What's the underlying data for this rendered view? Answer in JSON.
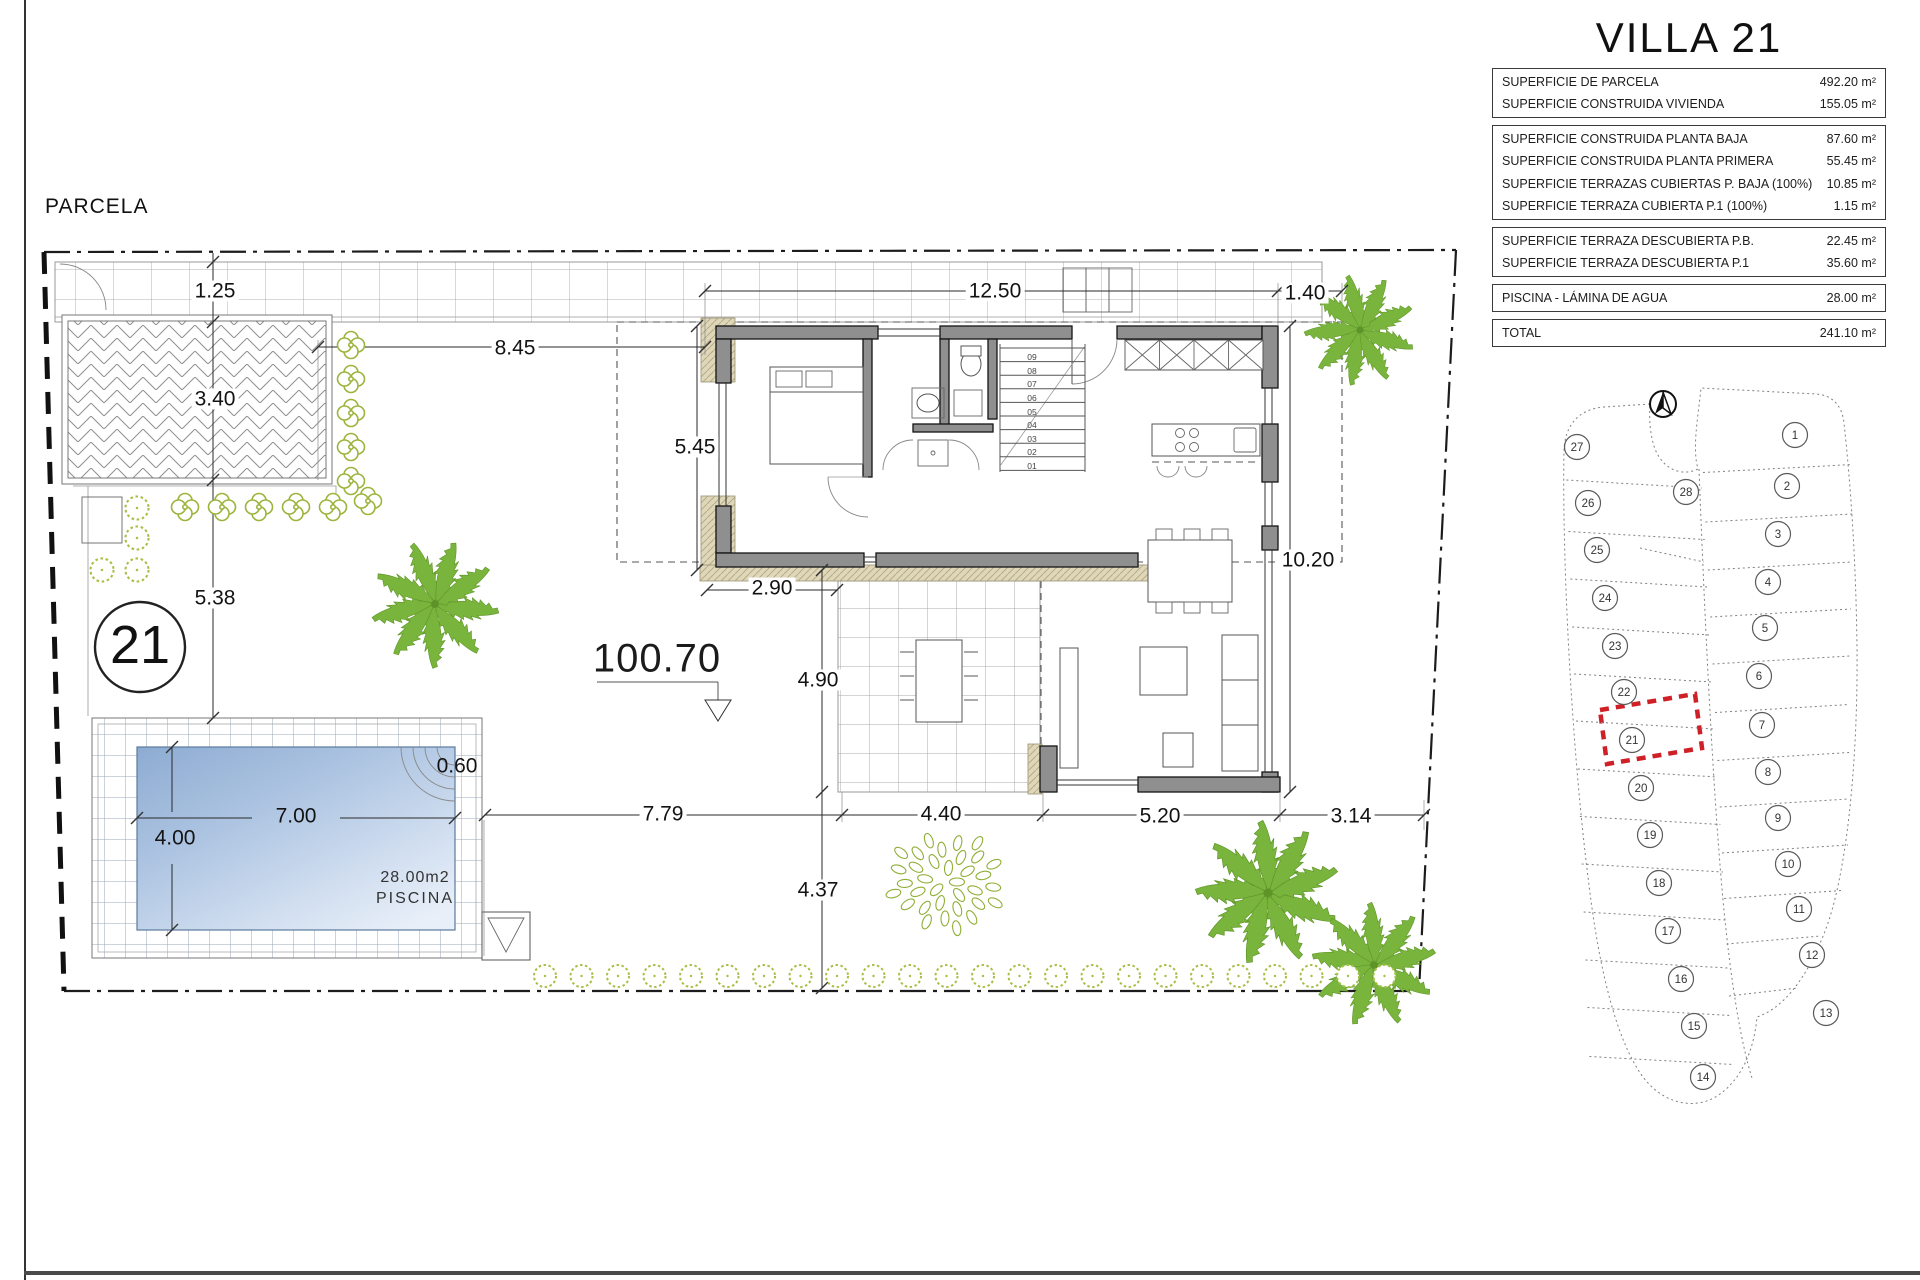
{
  "page": {
    "plan_label": "PARCELA"
  },
  "villa": {
    "title": "VILLA 21"
  },
  "area_table": {
    "groups": [
      {
        "rows": [
          {
            "label": "SUPERFICIE DE PARCELA",
            "value": "492.20 m²"
          },
          {
            "label": "SUPERFICIE CONSTRUIDA VIVIENDA",
            "value": "155.05 m²"
          }
        ]
      },
      {
        "rows": [
          {
            "label": "SUPERFICIE CONSTRUIDA PLANTA BAJA",
            "value": "87.60 m²"
          },
          {
            "label": "SUPERFICIE CONSTRUIDA PLANTA PRIMERA",
            "value": "55.45 m²"
          },
          {
            "label": "SUPERFICIE TERRAZAS CUBIERTAS P. BAJA (100%)",
            "value": "10.85 m²"
          },
          {
            "label": "SUPERFICIE TERRAZA CUBIERTA P.1 (100%)",
            "value": "1.15 m²"
          }
        ]
      },
      {
        "rows": [
          {
            "label": "SUPERFICIE TERRAZA DESCUBIERTA P.B.",
            "value": "22.45 m²"
          },
          {
            "label": "SUPERFICIE TERRAZA DESCUBIERTA P.1",
            "value": "35.60 m²"
          }
        ]
      },
      {
        "rows": [
          {
            "label": "PISCINA - LÁMINA DE AGUA",
            "value": "28.00 m²"
          }
        ]
      },
      {
        "rows": [
          {
            "label": "TOTAL",
            "value": "241.10 m²"
          }
        ]
      }
    ]
  },
  "plan": {
    "plot_number": "21",
    "level_mark": "100.70",
    "pool": {
      "area_label": "28.00m2",
      "name_label": "PISCINA"
    },
    "stair_steps": [
      "01",
      "02",
      "03",
      "04",
      "05",
      "06",
      "07",
      "08",
      "09"
    ],
    "dimensions": [
      {
        "text": "1.25",
        "x": 215,
        "y": 291
      },
      {
        "text": "3.40",
        "x": 215,
        "y": 399
      },
      {
        "text": "5.38",
        "x": 215,
        "y": 598
      },
      {
        "text": "8.45",
        "x": 515,
        "y": 348
      },
      {
        "text": "12.50",
        "x": 995,
        "y": 291
      },
      {
        "text": "1.40",
        "x": 1305,
        "y": 293
      },
      {
        "text": "5.45",
        "x": 695,
        "y": 447
      },
      {
        "text": "2.90",
        "x": 772,
        "y": 588
      },
      {
        "text": "4.90",
        "x": 818,
        "y": 680
      },
      {
        "text": "4.37",
        "x": 818,
        "y": 890
      },
      {
        "text": "7.79",
        "x": 663,
        "y": 814
      },
      {
        "text": "4.40",
        "x": 941,
        "y": 814
      },
      {
        "text": "5.20",
        "x": 1160,
        "y": 816
      },
      {
        "text": "3.14",
        "x": 1351,
        "y": 816
      },
      {
        "text": "10.20",
        "x": 1308,
        "y": 560
      },
      {
        "text": "7.00",
        "x": 296,
        "y": 816,
        "bg": false
      },
      {
        "text": "4.00",
        "x": 175,
        "y": 838,
        "bg": false
      },
      {
        "text": "0.60",
        "x": 457,
        "y": 766,
        "bg": false
      }
    ]
  },
  "site_map": {
    "highlighted_plot": "21",
    "plots": [
      {
        "n": "1",
        "x": 1795,
        "y": 435
      },
      {
        "n": "2",
        "x": 1787,
        "y": 486
      },
      {
        "n": "3",
        "x": 1778,
        "y": 534
      },
      {
        "n": "4",
        "x": 1768,
        "y": 582
      },
      {
        "n": "5",
        "x": 1765,
        "y": 628
      },
      {
        "n": "6",
        "x": 1759,
        "y": 676
      },
      {
        "n": "7",
        "x": 1762,
        "y": 725
      },
      {
        "n": "8",
        "x": 1768,
        "y": 772
      },
      {
        "n": "9",
        "x": 1778,
        "y": 818
      },
      {
        "n": "10",
        "x": 1788,
        "y": 864
      },
      {
        "n": "11",
        "x": 1799,
        "y": 909
      },
      {
        "n": "12",
        "x": 1812,
        "y": 955
      },
      {
        "n": "13",
        "x": 1826,
        "y": 1013
      },
      {
        "n": "14",
        "x": 1703,
        "y": 1077
      },
      {
        "n": "15",
        "x": 1694,
        "y": 1026
      },
      {
        "n": "16",
        "x": 1681,
        "y": 979
      },
      {
        "n": "17",
        "x": 1668,
        "y": 931
      },
      {
        "n": "18",
        "x": 1659,
        "y": 883
      },
      {
        "n": "19",
        "x": 1650,
        "y": 835
      },
      {
        "n": "20",
        "x": 1641,
        "y": 788
      },
      {
        "n": "21",
        "x": 1632,
        "y": 740
      },
      {
        "n": "22",
        "x": 1624,
        "y": 692
      },
      {
        "n": "23",
        "x": 1615,
        "y": 646
      },
      {
        "n": "24",
        "x": 1605,
        "y": 598
      },
      {
        "n": "25",
        "x": 1597,
        "y": 550
      },
      {
        "n": "26",
        "x": 1588,
        "y": 503
      },
      {
        "n": "27",
        "x": 1577,
        "y": 447
      },
      {
        "n": "28",
        "x": 1686,
        "y": 492
      }
    ]
  }
}
